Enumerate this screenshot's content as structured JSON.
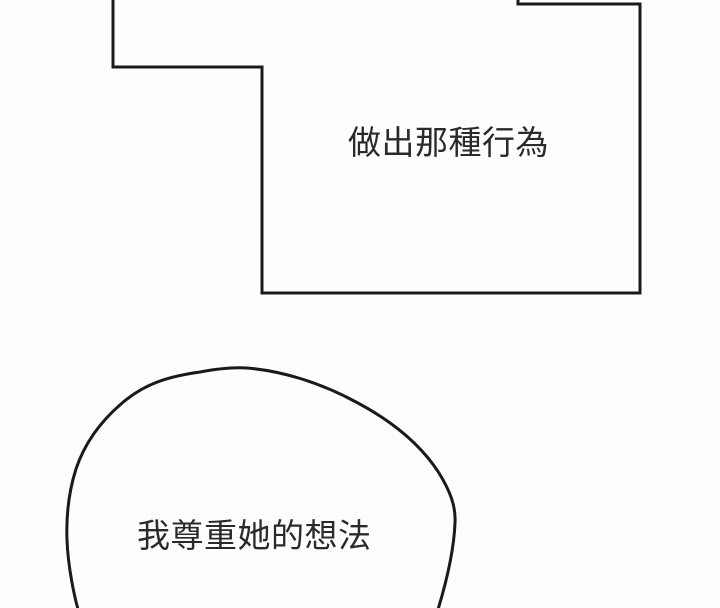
{
  "page": {
    "background_color": "#fdfdfd",
    "line_color": "#1a1a1a",
    "text_color": "#2a2a2a"
  },
  "panels": {
    "top_panel": {
      "dialogue": "做出那種行為"
    },
    "bottom_bubble": {
      "dialogue": "我尊重她的想法"
    }
  }
}
